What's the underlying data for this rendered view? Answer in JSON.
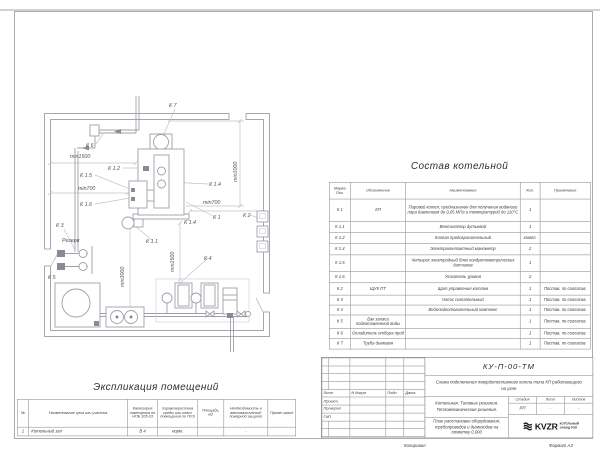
{
  "sheet": {
    "footer_left": "Копировал",
    "footer_right": "Формат А3"
  },
  "plan": {
    "labels": {
      "k7": "К 7",
      "k6": "К 6",
      "k5": "К 5",
      "k4": "К 4",
      "k3": "К 3",
      "k2": "К 2",
      "k1": "К 1",
      "k11": "К 1.1",
      "k12": "К 1.2",
      "k14a": "К 1.4",
      "k14b": "К 1.4",
      "k15": "К 1.5",
      "k16": "К 1.6",
      "reserve": "Резерв",
      "dim_min1500_left": "min1500",
      "dim_min700_left": "min700",
      "dim_min700_right": "min700",
      "dim_min1500_center": "min1500",
      "dim_min3000": "min3000",
      "dim_min1000": "min1000"
    }
  },
  "composition_table": {
    "title": "Состав котельной",
    "headers": [
      "Марка Поз.",
      "Обозначение",
      "Наименование",
      "Кол.",
      "Примечание"
    ],
    "rows": [
      [
        "К 1",
        "КП",
        "Паровой котел, предназначен для получения водяного пара давлением до 0,05 МПа и температурой до 110°С",
        "1",
        ""
      ],
      [
        "К 1.1",
        "",
        "Вентилятор дутьевой",
        "1",
        ""
      ],
      [
        "К 1.2",
        "",
        "Клапан предохранительный",
        "компл.",
        ""
      ],
      [
        "К 1.4",
        "",
        "Электроконтактный манометр",
        "2",
        ""
      ],
      [
        "К 1.5",
        "",
        "Четырех электродный блок кондуктометрических датчиков",
        "1",
        ""
      ],
      [
        "К 1.6",
        "",
        "Указатель уровня",
        "2",
        ""
      ],
      [
        "К 2",
        "ЩУК ПТ",
        "Щит управления котлом",
        "1",
        "Постав. по согласов."
      ],
      [
        "К 3",
        "",
        "Насос питательный",
        "1",
        "Постав. по согласов."
      ],
      [
        "К 4",
        "",
        "Водоподготовительный комплекс",
        "1",
        "Постав. по согласов."
      ],
      [
        "К 5",
        "Бак запаса подготовленной воды",
        "",
        "1",
        "Постав. по согласов."
      ],
      [
        "К 6",
        "Охладитель отбора проб",
        "",
        "1",
        "Постав. по согласов."
      ],
      [
        "К 7",
        "Труба дымовая",
        "",
        "1",
        "Постав. по согласов."
      ]
    ]
  },
  "explication_table": {
    "title": "Экспликация помещений",
    "headers": [
      "№",
      "Наименование цеха или участка",
      "Категория помещения по НПБ 105-03",
      "Характеристика среды или класс помещения по ПУЭ",
      "Площадь, м2",
      "Необходимость в автоматической пожарной защите",
      "Приме-чание"
    ],
    "rows": [
      [
        "1",
        "Котельный зал",
        "В 4",
        "норм.",
        "",
        "-",
        ""
      ]
    ]
  },
  "title_block": {
    "doc_code": "КУ-П-00-ТМ",
    "subtitle": "Схема подключения твердотопливного котла типа КП работающего на угле",
    "object_line1": "Котельная. Типовые решения.",
    "object_line2": "Тепломеханические решения.",
    "sheet_name": "План расстановки оборудования, трубопроводов и дымоходов на отметку 0,000",
    "cols": {
      "stage": "Стадия",
      "sheet": "Лист",
      "sheets": "Листов"
    },
    "vals": {
      "stage": "РП",
      "sheet": "-",
      "sheets": "-"
    },
    "sign_header": {
      "sheet": "Лист",
      "doc": "N докум",
      "sign": "Подп.",
      "date": "Дата"
    },
    "roles": [
      "Проект.",
      "Проверил",
      "ГИП"
    ],
    "logo_text": "KVZR",
    "company_line1": "КОТЕЛЬНЫЙ",
    "company_line2": "ЗАВОД РЭП"
  }
}
